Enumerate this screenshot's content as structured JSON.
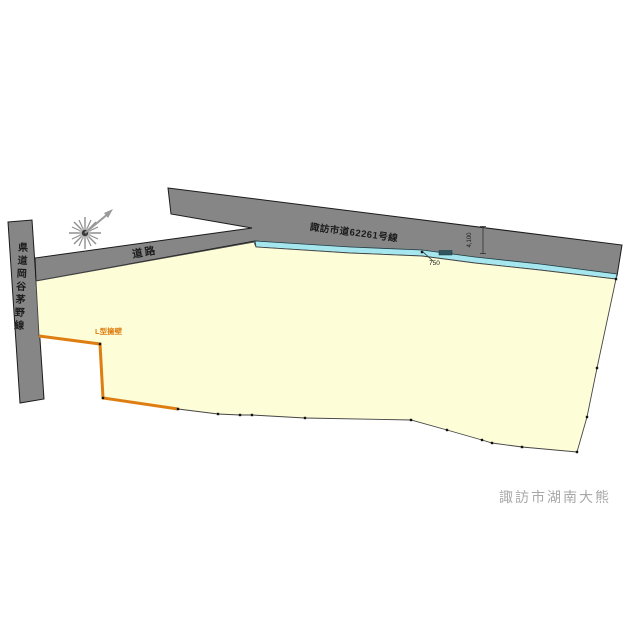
{
  "page": {
    "background": "#ffffff"
  },
  "labels": {
    "upper_road": "諏訪市道62261号線",
    "lower_road": "道路",
    "left_road": "県道岡谷茅野線",
    "retaining_wall": "L型擁壁",
    "location": "諏訪市湖南大熊"
  },
  "dimensions": {
    "road_width": "4,100",
    "gutter_width": "750"
  },
  "colors": {
    "road_fill": "#868686",
    "parcel_fill": "#FDFDD8",
    "gutter_fill": "#A6E6EE",
    "wall_orange": "#DE7E12",
    "outline_dark": "#1b1b1b",
    "location_text": "#A8A8A8",
    "compass_gray": "#8F8F8F"
  },
  "icons": {
    "north_arrow": "starburst with northeast arrow"
  }
}
